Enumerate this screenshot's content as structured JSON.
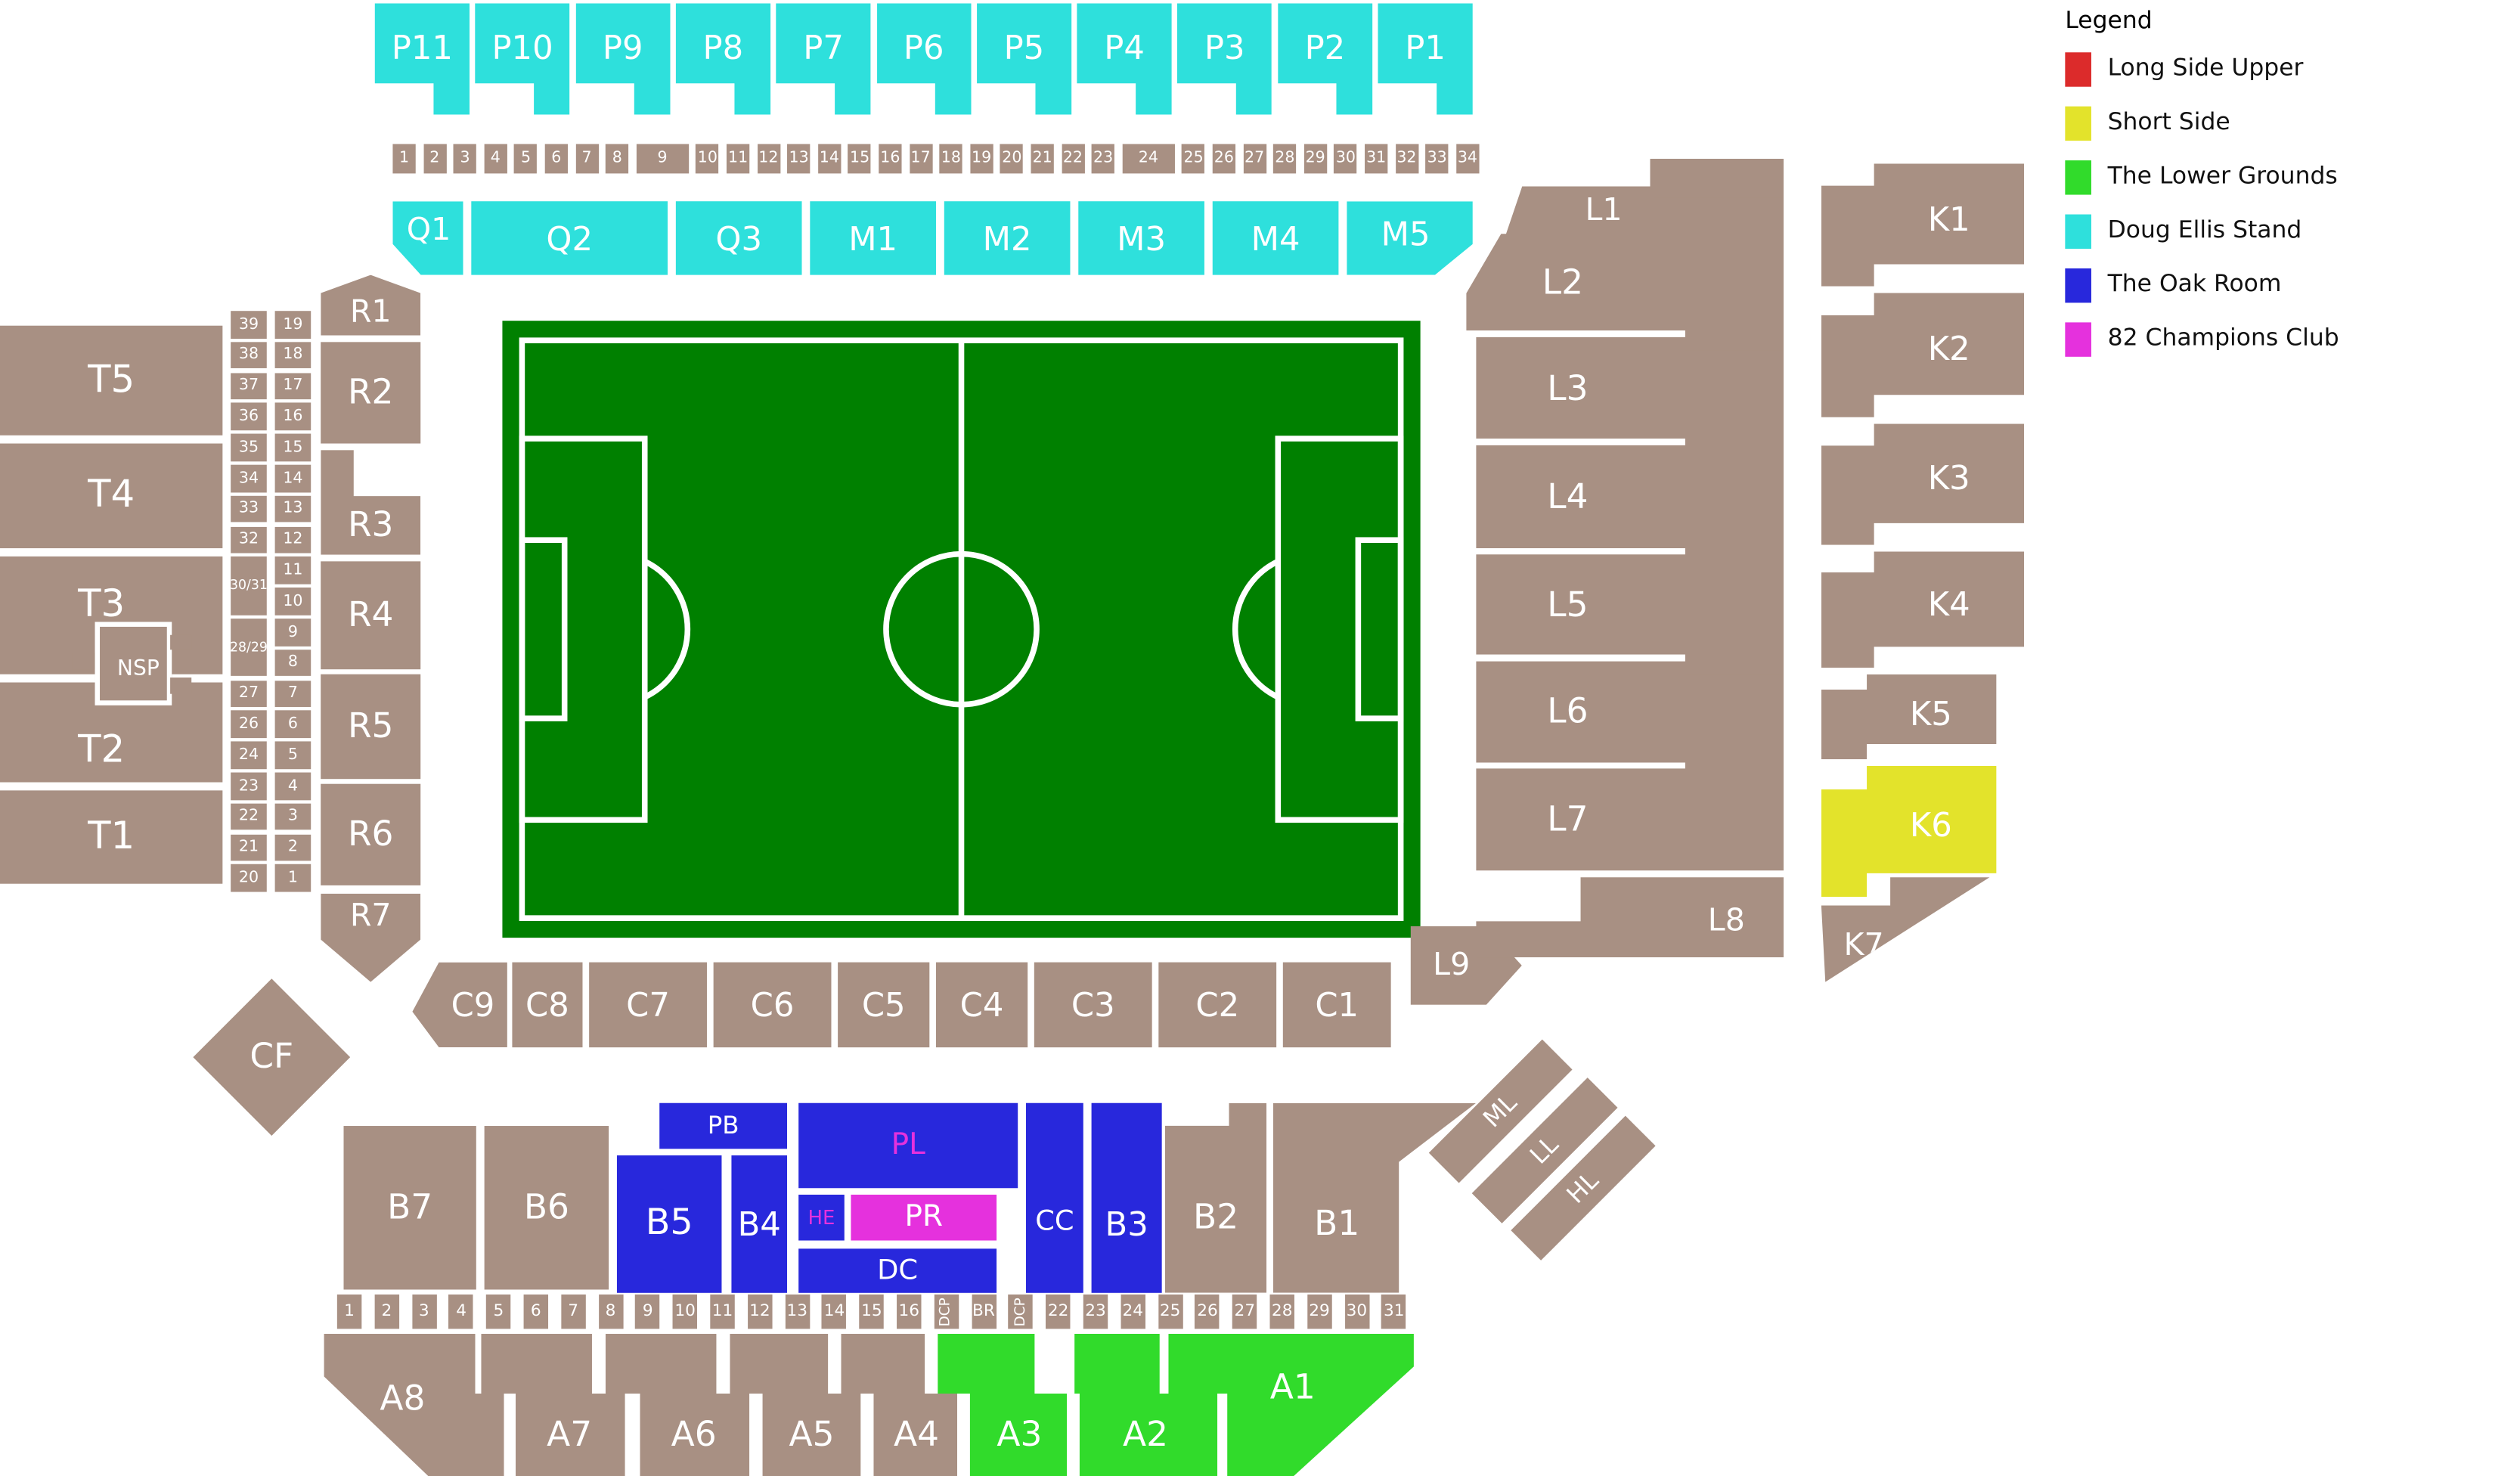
{
  "palette": {
    "tan": "#A89083",
    "cyan": "#2EE0DC",
    "blue": "#2828DC",
    "magenta": "#E531DD",
    "green": "#31DB2B",
    "yellow": "#E3E32B",
    "red": "#DC2B2B",
    "pitch_green": "#008000",
    "label_white": "#FFFFFF",
    "label_magenta": "#E531DD"
  },
  "legend": {
    "title": "Legend",
    "items": [
      {
        "label": "Long Side Upper",
        "color": "#DC2B2B"
      },
      {
        "label": "Short Side",
        "color": "#E3E32B"
      },
      {
        "label": "The Lower Grounds",
        "color": "#31DB2B"
      },
      {
        "label": "Doug Ellis Stand",
        "color": "#2EE0DC"
      },
      {
        "label": "The Oak Room",
        "color": "#2828DC"
      },
      {
        "label": "82 Champions Club",
        "color": "#E531DD"
      }
    ]
  },
  "strips": {
    "top_gates": [
      "1",
      "2",
      "3",
      "4",
      "5",
      "6",
      "7",
      "8",
      "9",
      "10",
      "11",
      "12",
      "13",
      "14",
      "15",
      "16",
      "17",
      "18",
      "19",
      "20",
      "21",
      "22",
      "23",
      "24",
      "25",
      "26",
      "27",
      "28",
      "29",
      "30",
      "31",
      "32",
      "33",
      "34"
    ],
    "left_outer_rows": [
      "39",
      "38",
      "37",
      "36",
      "35",
      "34",
      "33",
      "32",
      "30/31",
      "28/29",
      "27",
      "26",
      "24",
      "23",
      "22",
      "21",
      "20"
    ],
    "left_inner_rows": [
      "19",
      "18",
      "17",
      "16",
      "15",
      "14",
      "13",
      "12",
      "11",
      "10",
      "9",
      "8",
      "7",
      "6",
      "5",
      "4",
      "3",
      "2",
      "1"
    ],
    "bottom_gates": [
      "1",
      "2",
      "3",
      "4",
      "5",
      "6",
      "7",
      "8",
      "9",
      "10",
      "11",
      "12",
      "13",
      "14",
      "15",
      "16",
      "DCP",
      "BR",
      "DCP",
      "22",
      "23",
      "24",
      "25",
      "26",
      "27",
      "28",
      "29",
      "30",
      "31"
    ]
  },
  "sections": [
    {
      "id": "P11",
      "label": "P11",
      "color": "cyan",
      "text": "white"
    },
    {
      "id": "P10",
      "label": "P10",
      "color": "cyan",
      "text": "white"
    },
    {
      "id": "P9",
      "label": "P9",
      "color": "cyan",
      "text": "white"
    },
    {
      "id": "P8",
      "label": "P8",
      "color": "cyan",
      "text": "white"
    },
    {
      "id": "P7",
      "label": "P7",
      "color": "cyan",
      "text": "white"
    },
    {
      "id": "P6",
      "label": "P6",
      "color": "cyan",
      "text": "white"
    },
    {
      "id": "P5",
      "label": "P5",
      "color": "cyan",
      "text": "white"
    },
    {
      "id": "P4",
      "label": "P4",
      "color": "cyan",
      "text": "white"
    },
    {
      "id": "P3",
      "label": "P3",
      "color": "cyan",
      "text": "white"
    },
    {
      "id": "P2",
      "label": "P2",
      "color": "cyan",
      "text": "white"
    },
    {
      "id": "P1",
      "label": "P1",
      "color": "cyan",
      "text": "white"
    },
    {
      "id": "Q1",
      "label": "Q1",
      "color": "cyan",
      "text": "white"
    },
    {
      "id": "Q2",
      "label": "Q2",
      "color": "cyan",
      "text": "white"
    },
    {
      "id": "Q3",
      "label": "Q3",
      "color": "cyan",
      "text": "white"
    },
    {
      "id": "M1",
      "label": "M1",
      "color": "cyan",
      "text": "white"
    },
    {
      "id": "M2",
      "label": "M2",
      "color": "cyan",
      "text": "white"
    },
    {
      "id": "M3",
      "label": "M3",
      "color": "cyan",
      "text": "white"
    },
    {
      "id": "M4",
      "label": "M4",
      "color": "cyan",
      "text": "white"
    },
    {
      "id": "M5",
      "label": "M5",
      "color": "cyan",
      "text": "white"
    },
    {
      "id": "T5",
      "label": "T5",
      "color": "tan",
      "text": "white"
    },
    {
      "id": "T4",
      "label": "T4",
      "color": "tan",
      "text": "white"
    },
    {
      "id": "T3",
      "label": "T3",
      "color": "tan",
      "text": "white"
    },
    {
      "id": "T2",
      "label": "T2",
      "color": "tan",
      "text": "white"
    },
    {
      "id": "T1",
      "label": "T1",
      "color": "tan",
      "text": "white"
    },
    {
      "id": "NSP",
      "label": "NSP",
      "color": "tan",
      "text": "white"
    },
    {
      "id": "R1",
      "label": "R1",
      "color": "tan",
      "text": "white"
    },
    {
      "id": "R2",
      "label": "R2",
      "color": "tan",
      "text": "white"
    },
    {
      "id": "R3",
      "label": "R3",
      "color": "tan",
      "text": "white"
    },
    {
      "id": "R4",
      "label": "R4",
      "color": "tan",
      "text": "white"
    },
    {
      "id": "R5",
      "label": "R5",
      "color": "tan",
      "text": "white"
    },
    {
      "id": "R6",
      "label": "R6",
      "color": "tan",
      "text": "white"
    },
    {
      "id": "R7",
      "label": "R7",
      "color": "tan",
      "text": "white"
    },
    {
      "id": "C9",
      "label": "C9",
      "color": "tan",
      "text": "white"
    },
    {
      "id": "C8",
      "label": "C8",
      "color": "tan",
      "text": "white"
    },
    {
      "id": "C7",
      "label": "C7",
      "color": "tan",
      "text": "white"
    },
    {
      "id": "C6",
      "label": "C6",
      "color": "tan",
      "text": "white"
    },
    {
      "id": "C5",
      "label": "C5",
      "color": "tan",
      "text": "white"
    },
    {
      "id": "C4",
      "label": "C4",
      "color": "tan",
      "text": "white"
    },
    {
      "id": "C3",
      "label": "C3",
      "color": "tan",
      "text": "white"
    },
    {
      "id": "C2",
      "label": "C2",
      "color": "tan",
      "text": "white"
    },
    {
      "id": "C1",
      "label": "C1",
      "color": "tan",
      "text": "white"
    },
    {
      "id": "CF",
      "label": "CF",
      "color": "tan",
      "text": "white"
    },
    {
      "id": "L9",
      "label": "L9",
      "color": "tan",
      "text": "white"
    },
    {
      "id": "L1",
      "label": "L1",
      "color": "tan",
      "text": "white"
    },
    {
      "id": "L2",
      "label": "L2",
      "color": "tan",
      "text": "white"
    },
    {
      "id": "L3",
      "label": "L3",
      "color": "tan",
      "text": "white"
    },
    {
      "id": "L4",
      "label": "L4",
      "color": "tan",
      "text": "white"
    },
    {
      "id": "L5",
      "label": "L5",
      "color": "tan",
      "text": "white"
    },
    {
      "id": "L6",
      "label": "L6",
      "color": "tan",
      "text": "white"
    },
    {
      "id": "L7",
      "label": "L7",
      "color": "tan",
      "text": "white"
    },
    {
      "id": "L8",
      "label": "L8",
      "color": "tan",
      "text": "white"
    },
    {
      "id": "K1",
      "label": "K1",
      "color": "tan",
      "text": "white"
    },
    {
      "id": "K2",
      "label": "K2",
      "color": "tan",
      "text": "white"
    },
    {
      "id": "K3",
      "label": "K3",
      "color": "tan",
      "text": "white"
    },
    {
      "id": "K4",
      "label": "K4",
      "color": "tan",
      "text": "white"
    },
    {
      "id": "K5",
      "label": "K5",
      "color": "tan",
      "text": "white"
    },
    {
      "id": "K6",
      "label": "K6",
      "color": "yellow",
      "text": "white"
    },
    {
      "id": "K7",
      "label": "K7",
      "color": "tan",
      "text": "white"
    },
    {
      "id": "B7",
      "label": "B7",
      "color": "tan",
      "text": "white"
    },
    {
      "id": "B6",
      "label": "B6",
      "color": "tan",
      "text": "white"
    },
    {
      "id": "B5",
      "label": "B5",
      "color": "blue",
      "text": "white"
    },
    {
      "id": "B4",
      "label": "B4",
      "color": "blue",
      "text": "white"
    },
    {
      "id": "B3",
      "label": "B3",
      "color": "blue",
      "text": "white"
    },
    {
      "id": "B2",
      "label": "B2",
      "color": "tan",
      "text": "white"
    },
    {
      "id": "B1",
      "label": "B1",
      "color": "tan",
      "text": "white"
    },
    {
      "id": "PB",
      "label": "PB",
      "color": "blue",
      "text": "white"
    },
    {
      "id": "PL",
      "label": "PL",
      "color": "blue",
      "text": "magenta"
    },
    {
      "id": "HE",
      "label": "HE",
      "color": "blue",
      "text": "magenta"
    },
    {
      "id": "PR",
      "label": "PR",
      "color": "magenta",
      "text": "white"
    },
    {
      "id": "DC",
      "label": "DC",
      "color": "blue",
      "text": "white"
    },
    {
      "id": "CC",
      "label": "CC",
      "color": "blue",
      "text": "white"
    },
    {
      "id": "A8",
      "label": "A8",
      "color": "tan",
      "text": "white"
    },
    {
      "id": "A7",
      "label": "A7",
      "color": "tan",
      "text": "white"
    },
    {
      "id": "A6",
      "label": "A6",
      "color": "tan",
      "text": "white"
    },
    {
      "id": "A5",
      "label": "A5",
      "color": "tan",
      "text": "white"
    },
    {
      "id": "A4",
      "label": "A4",
      "color": "tan",
      "text": "white"
    },
    {
      "id": "A3",
      "label": "A3",
      "color": "green",
      "text": "white"
    },
    {
      "id": "A2",
      "label": "A2",
      "color": "green",
      "text": "white"
    },
    {
      "id": "A1",
      "label": "A1",
      "color": "green",
      "text": "white"
    },
    {
      "id": "ML",
      "label": "ML",
      "color": "tan",
      "text": "white"
    },
    {
      "id": "LL",
      "label": "LL",
      "color": "tan",
      "text": "white"
    },
    {
      "id": "HL",
      "label": "HL",
      "color": "tan",
      "text": "white"
    }
  ]
}
